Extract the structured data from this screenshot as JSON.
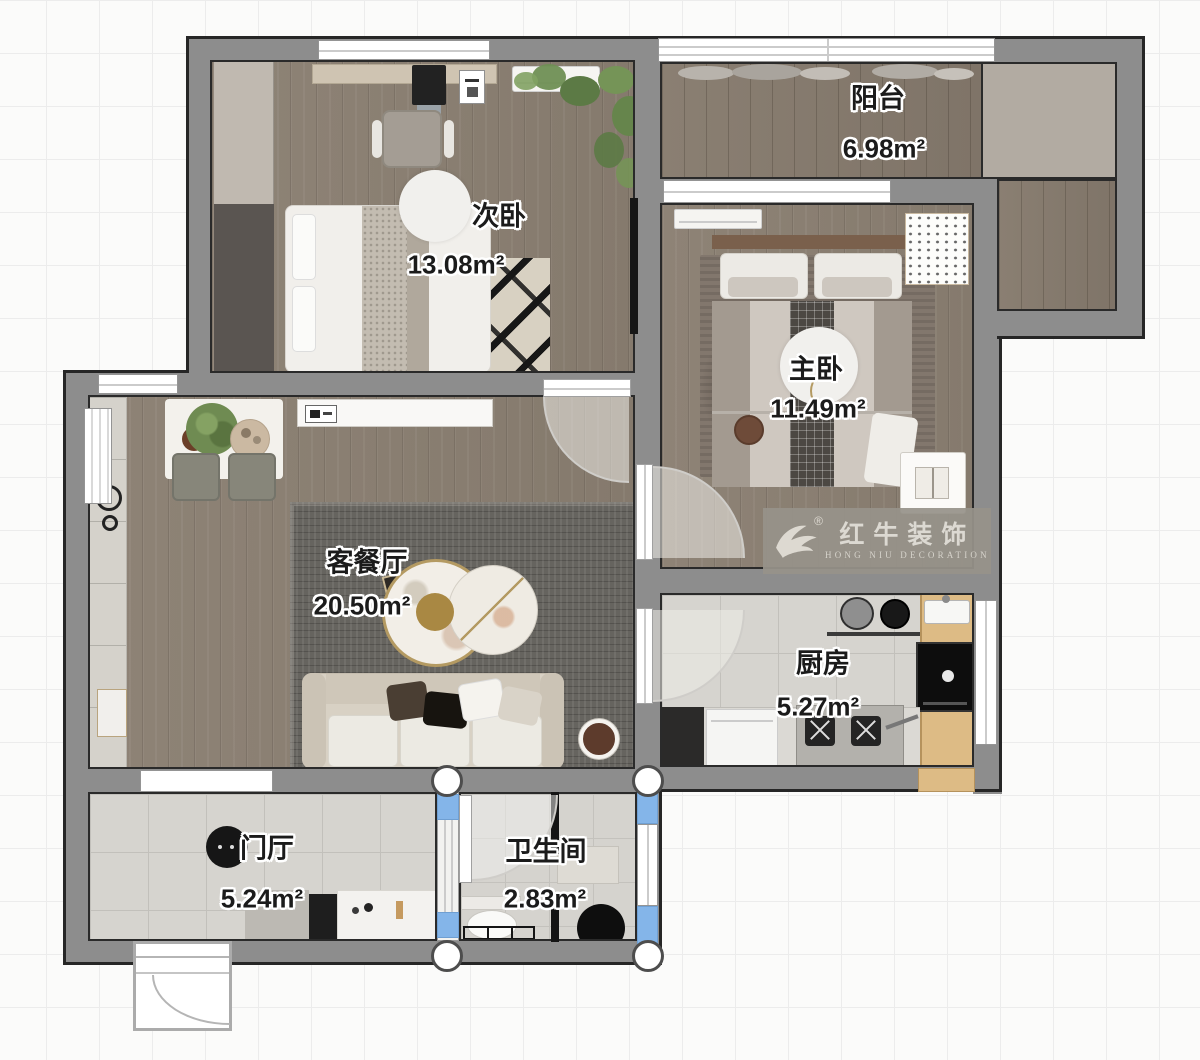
{
  "rooms": [
    {
      "key": "secondary-bedroom",
      "name": "次卧",
      "area": "13.08m²"
    },
    {
      "key": "balcony",
      "name": "阳台",
      "area": "6.98m²"
    },
    {
      "key": "master-bedroom",
      "name": "主卧",
      "area": "11.49m²"
    },
    {
      "key": "living-dining",
      "name": "客餐厅",
      "area": "20.50m²"
    },
    {
      "key": "kitchen",
      "name": "厨房",
      "area": "5.27m²"
    },
    {
      "key": "entry-hall",
      "name": "门厅",
      "area": "5.24m²"
    },
    {
      "key": "bathroom",
      "name": "卫生间",
      "area": "2.83m²"
    }
  ],
  "watermark": {
    "brand_cn": "红牛装饰",
    "brand_en": "HONG NIU DECORATION",
    "registered_mark": "®"
  },
  "colors": {
    "wall": "#8d8d8d",
    "wall_outline": "#262626",
    "window_blue": "#84b5e9",
    "counter_wood": "#ddbb85",
    "accent_gold": "#b49a62"
  }
}
